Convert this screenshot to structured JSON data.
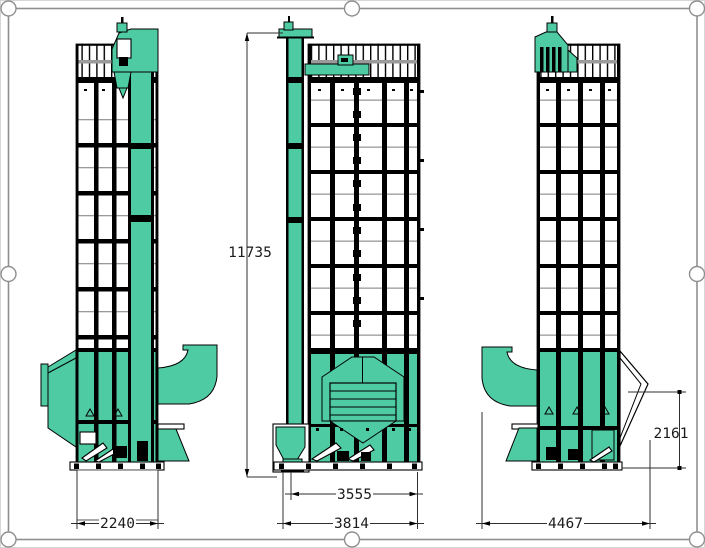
{
  "drawing": {
    "dimensions": {
      "overall_height": "11735",
      "left_view_width": "2240",
      "front_inner_width": "3555",
      "front_overall_width": "3814",
      "right_view_width": "4467",
      "base_height": "2161"
    },
    "colors": {
      "machine_accent": "#4FCBA3",
      "line_color": "#000000",
      "frame_color": "#8F8F8F",
      "dimension_text": "#1C1C1C"
    }
  }
}
